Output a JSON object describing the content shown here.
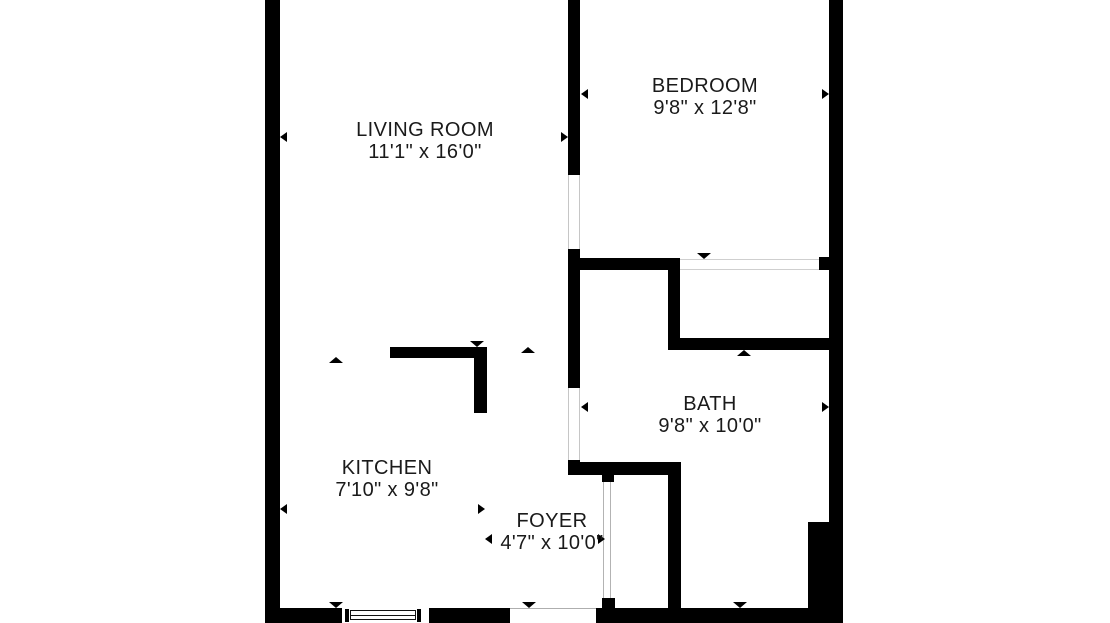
{
  "colors": {
    "background": "#ffffff",
    "walls": "#000000",
    "text": "#1a1a1a",
    "opening_lines": "#c6c6c6"
  },
  "rooms": [
    {
      "name": "LIVING ROOM",
      "dimensions": "11'1\" x 16'0\""
    },
    {
      "name": "BEDROOM",
      "dimensions": "9'8\" x 12'8\""
    },
    {
      "name": "BATH",
      "dimensions": "9'8\" x 10'0\""
    },
    {
      "name": "KITCHEN",
      "dimensions": "7'10\" x 9'8\""
    },
    {
      "name": "FOYER",
      "dimensions": "4'7\" x 10'0\""
    }
  ]
}
